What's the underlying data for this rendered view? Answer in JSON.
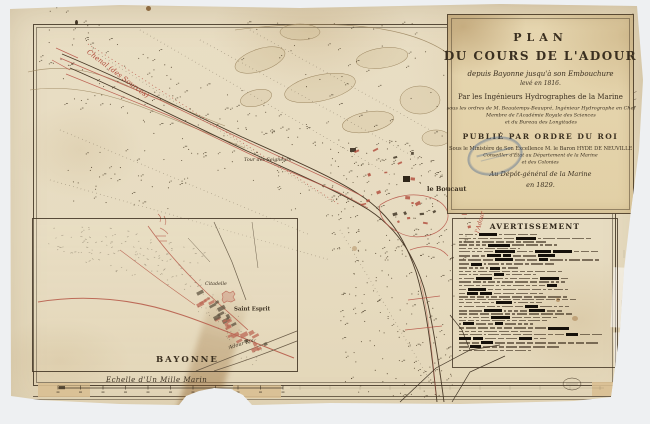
{
  "colors": {
    "backdrop": "#eef0f2",
    "paper": "#e8dcc2",
    "ink": "#3f3324",
    "red_ink": "#b04a3a",
    "stamp_blue": "#4a6892"
  },
  "cartouche": {
    "lines": [
      "PLAN",
      "DU COURS DE L'ADOUR",
      "depuis Bayonne jusqu'à son Embouchure",
      "levé en 1816.",
      "Par les Ingénieurs Hydrographes de la Marine",
      "sous les ordres de M. Beautemps-Beaupré, Ingénieur Hydrographe en Chef",
      "Membre de l'Académie Royale des Sciences",
      "et du Bureau des Longitudes",
      "PUBLIÉ PAR ORDRE DU ROI",
      "Sous le Ministère de Son Excellence M. le Baron HYDE DE NEUVILLE",
      "Conseiller d'État au Département de la Marine",
      "et des Colonies",
      "Au Dépôt-général de la Marine",
      "en 1829."
    ]
  },
  "notice": {
    "title": "AVERTISSEMENT"
  },
  "map_labels": {
    "chenal": "Chenal (des Sources)",
    "tour_des_seigneurs": "Tour des Seigneurs",
    "le_boucaut": "le Boucaut",
    "adour": "l'Adour"
  },
  "inset_labels": {
    "citadelle": "Citadelle",
    "saint_esprit": "Saint Esprit",
    "bayonne": "BAYONNE",
    "adour_riv": "Adour Riv."
  },
  "scale_bar": {
    "label": "Echelle d'Un Mille Marin"
  }
}
